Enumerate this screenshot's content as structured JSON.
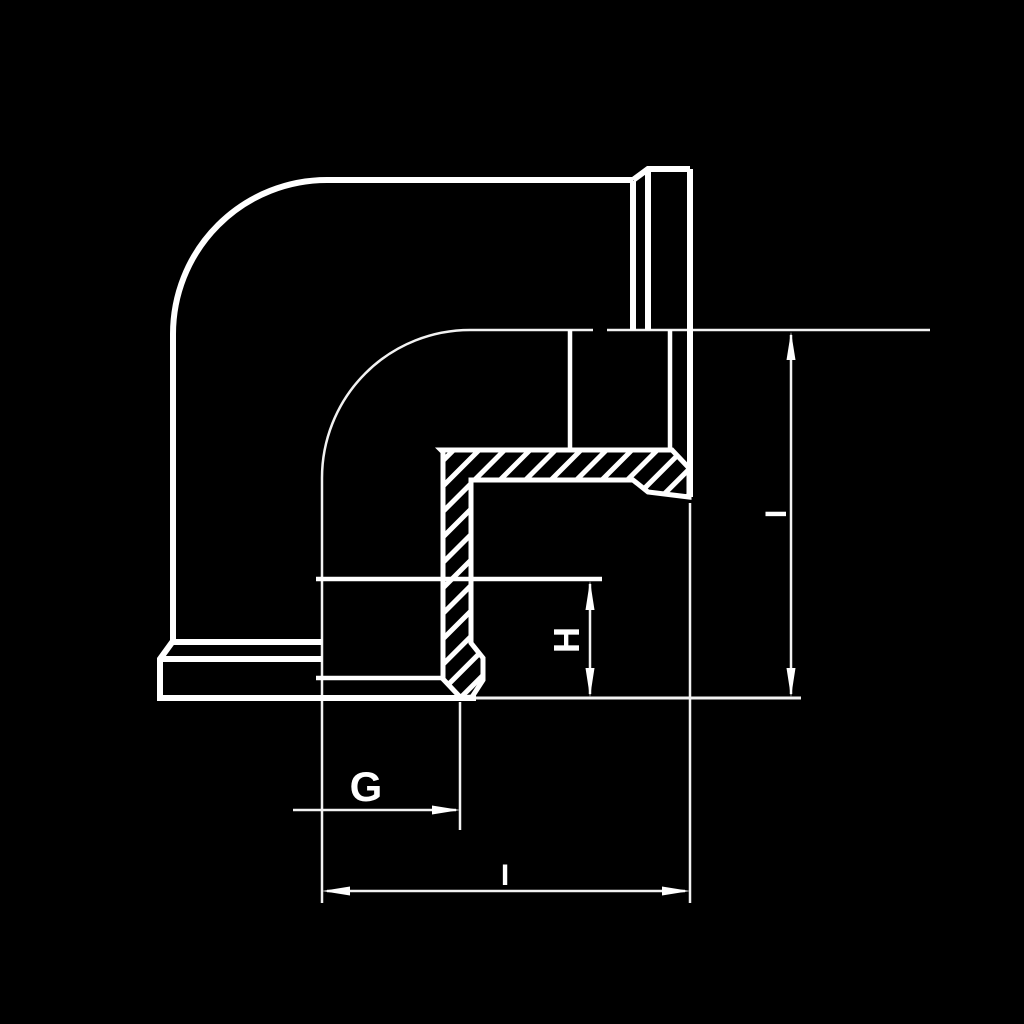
{
  "drawing": {
    "background_color": "#000000",
    "line_color": "#ffffff",
    "labels": {
      "g": "G",
      "h": "H",
      "i_horizontal": "I",
      "i_vertical": "I"
    }
  }
}
